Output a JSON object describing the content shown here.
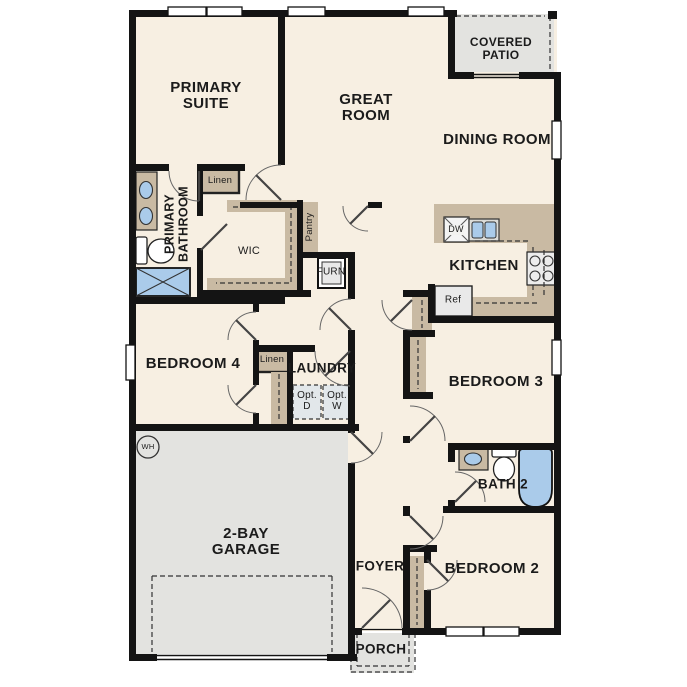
{
  "plan": {
    "rooms": {
      "primary_suite": "PRIMARY SUITE",
      "great_room": "GREAT ROOM",
      "dining_room": "DINING ROOM",
      "covered_patio": "COVERED PATIO",
      "primary_bathroom": "PRIMARY BATHROOM",
      "wic": "WIC",
      "kitchen": "KITCHEN",
      "bedroom_4": "BEDROOM 4",
      "laundry": "LAUNDRY",
      "bedroom_3": "BEDROOM 3",
      "bath_2": "BATH 2",
      "garage": "2-BAY GARAGE",
      "foyer": "FOYER",
      "bedroom_2": "BEDROOM 2",
      "porch": "PORCH"
    },
    "closets": {
      "linen_1": "Linen",
      "linen_2": "Linen",
      "pantry": "Pantry"
    },
    "fixtures": {
      "dishwasher": "DW",
      "refrigerator": "Ref",
      "furnace": "FURN",
      "water_heater": "WH",
      "optional_dryer": "Opt. D",
      "optional_washer": "Opt. W"
    },
    "colors": {
      "floor": "#f7efe2",
      "outdoor_gray": "#e3e3e0",
      "cabinet_tan": "#c9baa3",
      "fixture_blue": "#aacbea",
      "wall": "#141414"
    }
  }
}
